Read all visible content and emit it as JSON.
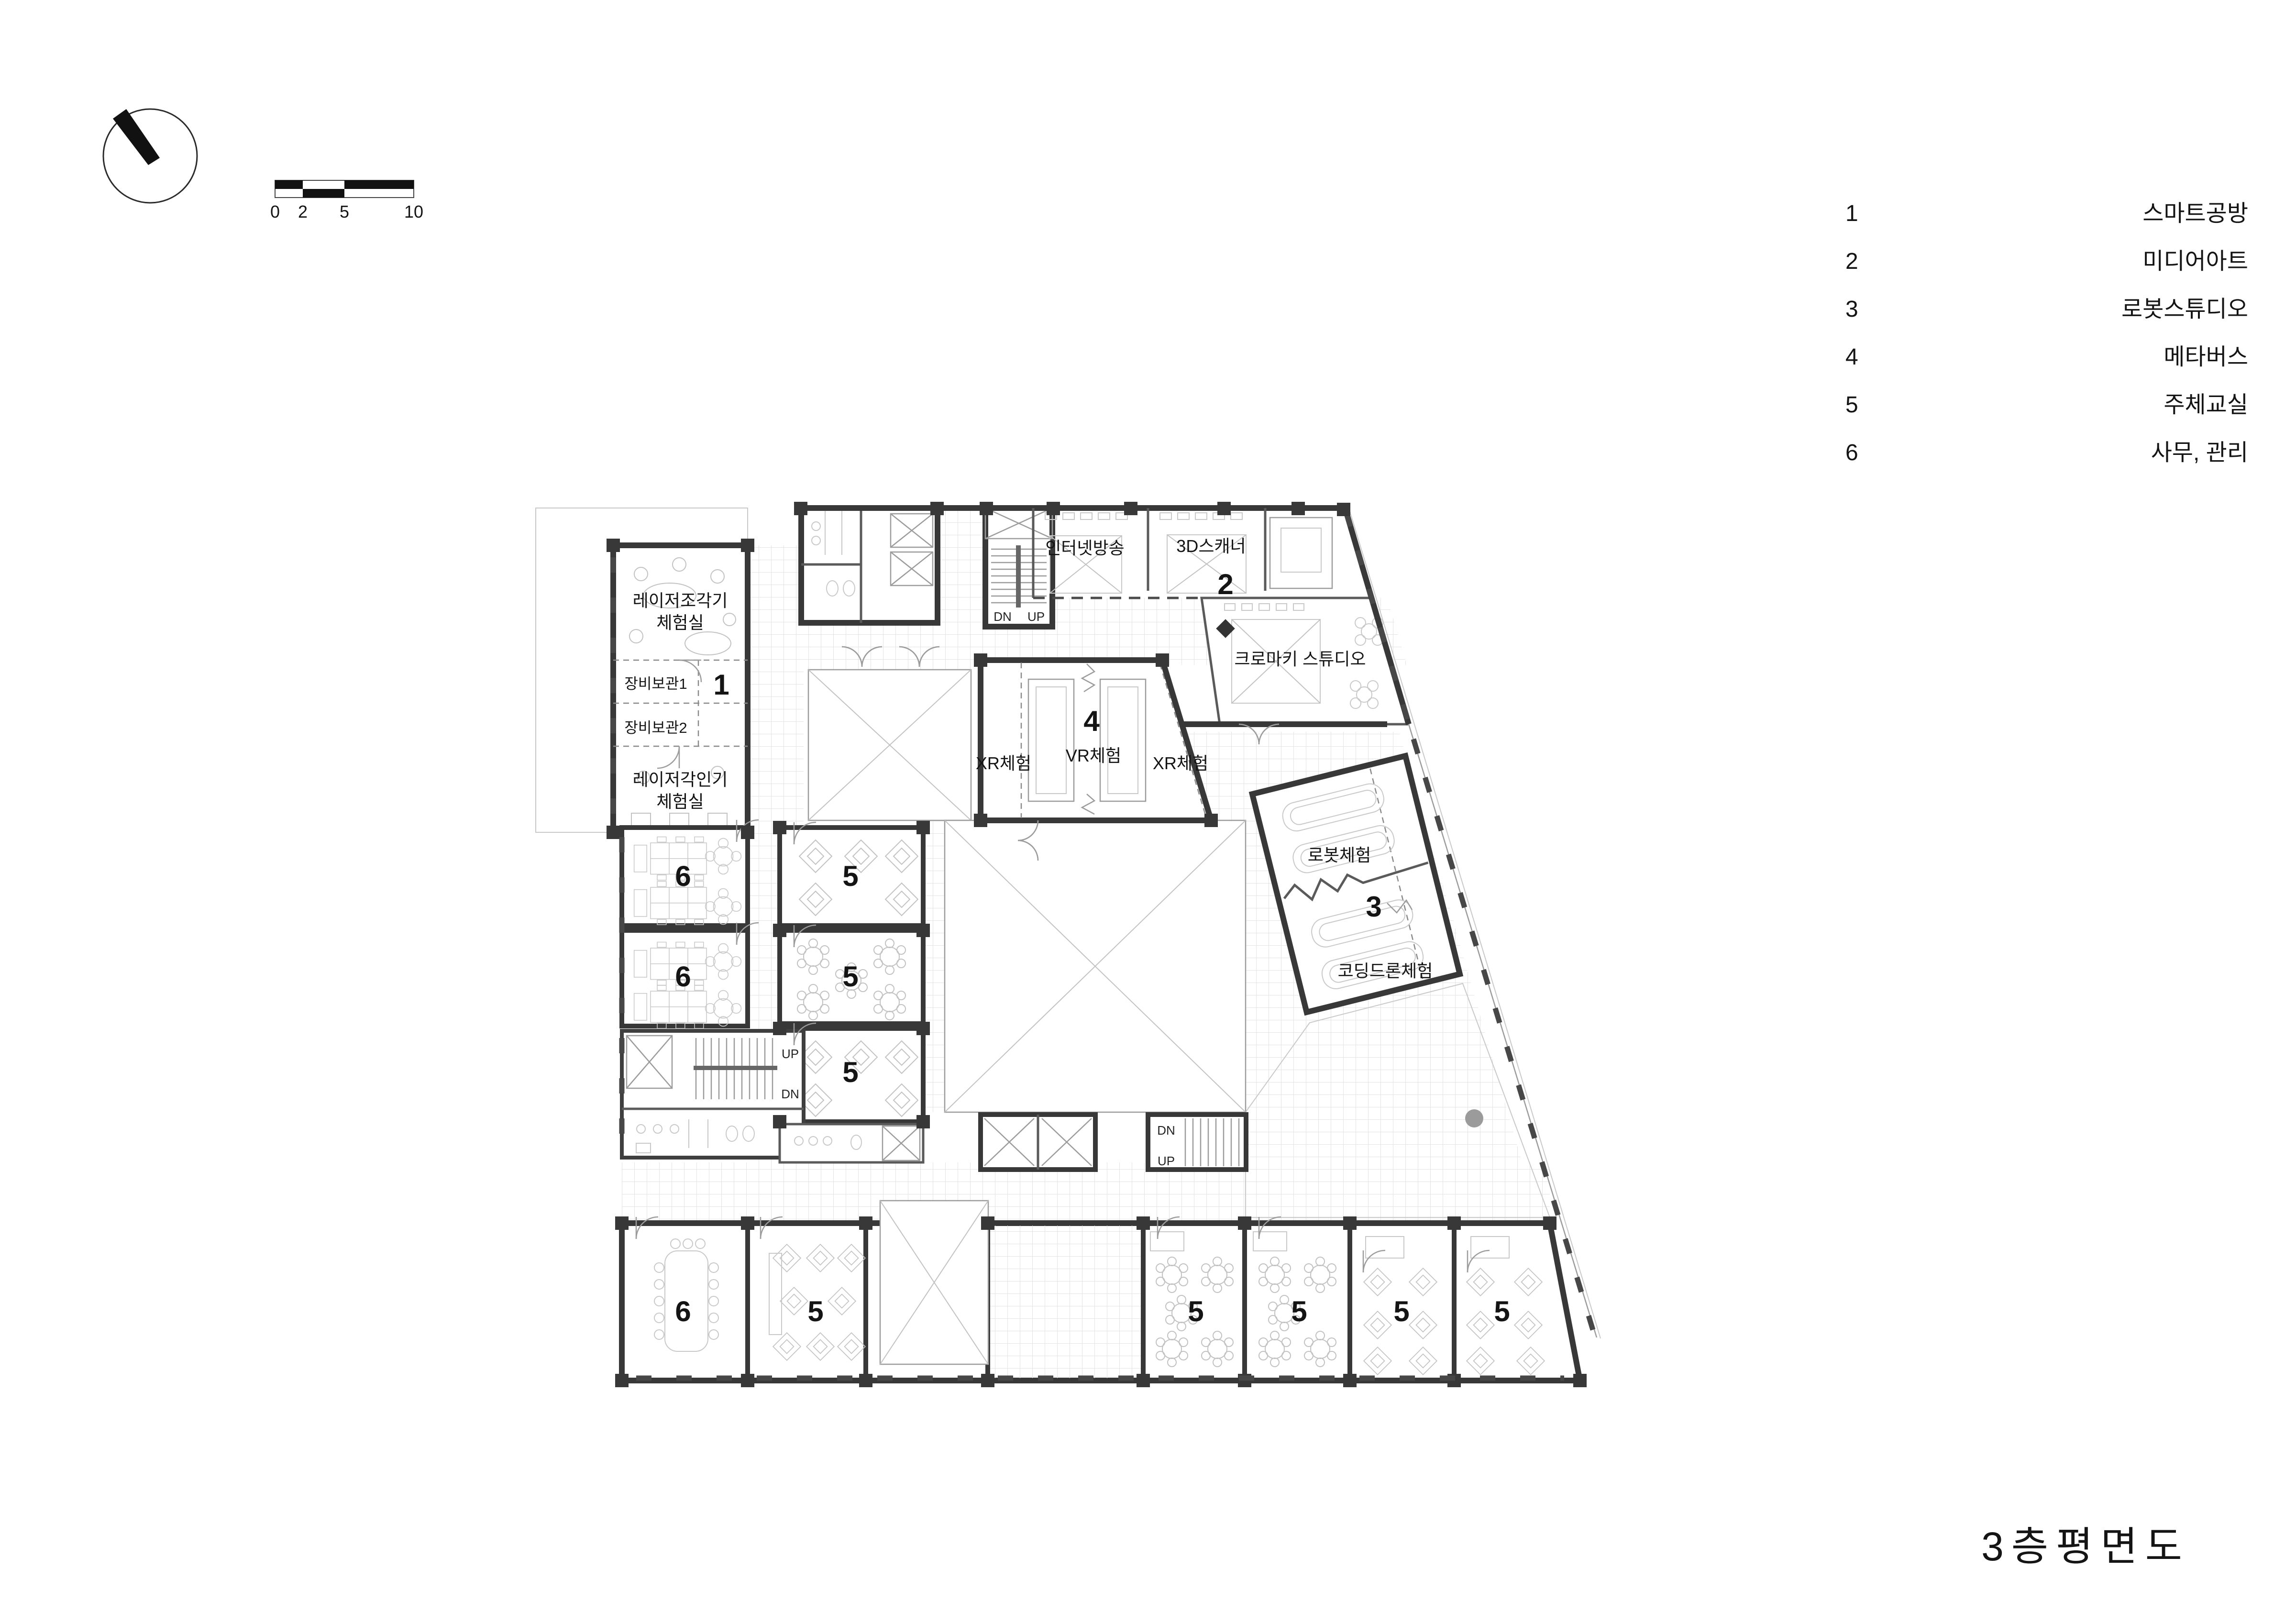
{
  "compass": {
    "icon": "north-arrow"
  },
  "scale_bar": {
    "ticks": [
      "0",
      "2",
      "5",
      "10"
    ]
  },
  "legend": {
    "items": [
      {
        "num": "1",
        "label": "스마트공방"
      },
      {
        "num": "2",
        "label": "미디어아트"
      },
      {
        "num": "3",
        "label": "로봇스튜디오"
      },
      {
        "num": "4",
        "label": "메타버스"
      },
      {
        "num": "5",
        "label": "주체교실"
      },
      {
        "num": "6",
        "label": "사무, 관리"
      }
    ]
  },
  "title": "3층평면도",
  "stairs": {
    "up": "UP",
    "dn": "DN"
  },
  "numbers": {
    "n1": "1",
    "n2": "2",
    "n3": "3",
    "n4": "4",
    "n5": "5",
    "n6": "6"
  },
  "rooms": {
    "laser_sculptor_1": "레이저조각기",
    "laser_sculptor_2": "체험실",
    "equip_storage_1": "장비보관1",
    "equip_storage_2": "장비보관2",
    "laser_engraver_1": "레이저각인기",
    "laser_engraver_2": "체험실",
    "internet_broadcast": "인터넷방송",
    "scanner_3d": "3D스캐너",
    "chroma_key_studio": "크로마키 스튜디오",
    "vr_experience": "VR체험",
    "xr_experience": "XR체험",
    "robot_experience": "로봇체험",
    "coding_drone": "코딩드론체험"
  }
}
